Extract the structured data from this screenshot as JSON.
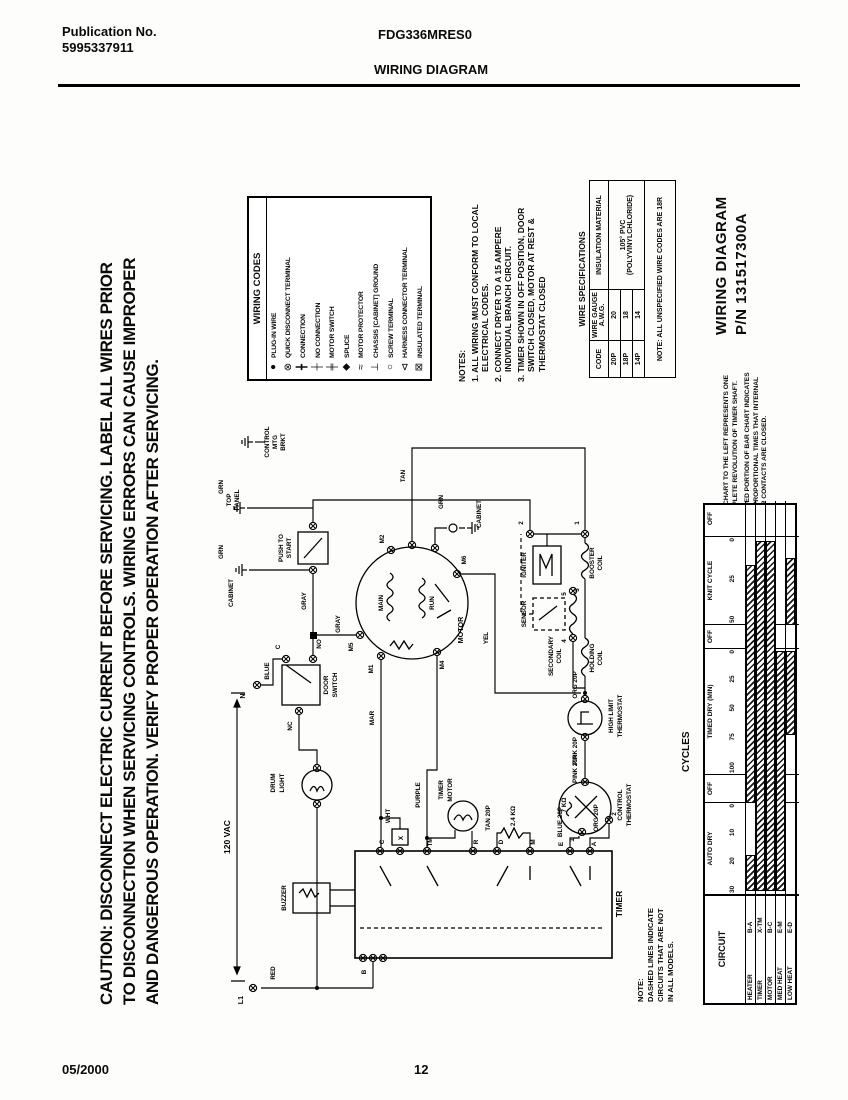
{
  "header": {
    "publication_label": "Publication No.",
    "publication_no": "5995337911",
    "model": "FDG336MRES0",
    "title": "WIRING DIAGRAM"
  },
  "footer": {
    "date": "05/2000",
    "page": "12"
  },
  "caution_lines": [
    "CAUTION: DISCONNECT ELECTRIC CURRENT BEFORE SERVICING. LABEL ALL WIRES PRIOR",
    "TO DISCONNECTION WHEN SERVICING CONTROLS. WIRING ERRORS CAN CAUSE IMPROPER",
    "AND DANGEROUS OPERATION. VERIFY PROPER OPERATION AFTER SERVICING."
  ],
  "legend": {
    "title": "WIRING CODES",
    "items": [
      {
        "name": "plug-in-wire",
        "glyph": "●",
        "label": "PLUG-IN WIRE"
      },
      {
        "name": "quick-disconnect-terminal",
        "glyph": "⊗",
        "label": "QUICK DISCONNECT TERMINAL"
      },
      {
        "name": "connection",
        "glyph": "╋",
        "label": "CONNECTION"
      },
      {
        "name": "no-connection",
        "glyph": "┼",
        "label": "NO CONNECTION"
      },
      {
        "name": "motor-switch",
        "glyph": "╪",
        "label": "MOTOR SWITCH"
      },
      {
        "name": "splice",
        "glyph": "◆",
        "label": "SPLICE"
      },
      {
        "name": "motor-protector",
        "glyph": "≈",
        "label": "MOTOR PROTECTOR"
      },
      {
        "name": "chassis-cabinet-ground",
        "glyph": "⊥",
        "label": "CHASSIS [CABINET] GROUND"
      },
      {
        "name": "screw-terminal",
        "glyph": "○",
        "label": "SCREW TERMINAL"
      },
      {
        "name": "harness-connector-terminal",
        "glyph": "⊲",
        "label": "HARNESS CONNECTOR TERMINAL"
      },
      {
        "name": "insulated-terminal",
        "glyph": "⊠",
        "label": "INSULATED TERMINAL"
      }
    ]
  },
  "notes": {
    "title": "NOTES:",
    "items": [
      "1. ALL WIRING MUST CONFORM TO LOCAL ELECTRICAL CODES.",
      "2. CONNECT DRYER TO A 15 AMPERE INDIVIDUAL BRANCH CIRCUIT.",
      "3. TIMER SHOWN IN OFF POSITION, DOOR SWITCH CLOSED, MOTOR AT REST & THERMOSTAT CLOSED"
    ]
  },
  "wire_specs": {
    "title": "WIRE SPECIFICATIONS",
    "col_code": "CODE",
    "col_gauge": "WIRE GAUGE A.W.G.",
    "col_insulation": "INSULATION MATERIAL",
    "rows": [
      [
        "20P",
        "20"
      ],
      [
        "18P",
        "18"
      ],
      [
        "14P",
        "14"
      ]
    ],
    "insulation": "105° PVC (POLYVINYLCHLORIDE)",
    "note": "NOTE: ALL UNSPECIFIED WIRE CODES ARE 18R"
  },
  "side_title": {
    "line1": "WIRING DIAGRAM",
    "line2": "P/N 131517300A"
  },
  "bar_note_lines": [
    "BAR CHART TO THE LEFT REPRESENTS ONE",
    "COMPLETE REVOLUTION OF TIMER SHAFT.",
    "SHADED PORTION OF BAR CHART INDICATES",
    "THE PROPORTIONAL TIMES THAT INTERNAL",
    "TIMER CONTACTS ARE CLOSED."
  ],
  "dashed_note_lines": [
    "NOTE:",
    "DASHED LINES INDICATE",
    "CIRCUITS THAT ARE NOT",
    "IN ALL MODELS."
  ],
  "cycles": {
    "title": "CYCLES",
    "circuit_header": "CIRCUIT",
    "sections": [
      {
        "label": "AUTO DRY",
        "x": 108,
        "w": 92,
        "ticks": [
          "30",
          "20",
          "10",
          "0"
        ]
      },
      {
        "label": "OFF",
        "x": 200,
        "w": 28,
        "ticks": []
      },
      {
        "label": "TIMED DRY (MIN)",
        "x": 228,
        "w": 126,
        "ticks": [
          "100",
          "75",
          "50",
          "25",
          "0"
        ]
      },
      {
        "label": "OFF",
        "x": 354,
        "w": 24,
        "ticks": []
      },
      {
        "label": "KNIT CYCLE",
        "x": 378,
        "w": 88,
        "ticks": [
          "50",
          "25",
          "0"
        ]
      },
      {
        "label": "OFF",
        "x": 466,
        "w": 36,
        "ticks": []
      }
    ],
    "rows": [
      {
        "name": "HEATER",
        "code": "B-A",
        "segments": [
          [
            112,
            148
          ],
          [
            200,
            438
          ]
        ]
      },
      {
        "name": "TIMER",
        "code": "X-TM",
        "segments": [
          [
            112,
            462
          ]
        ]
      },
      {
        "name": "MOTOR",
        "code": "B-C",
        "segments": [
          [
            112,
            462
          ]
        ]
      },
      {
        "name": "MED HEAT",
        "code": "E-M",
        "segments": [
          [
            112,
            352
          ]
        ]
      },
      {
        "name": "LOW HEAT",
        "code": "E-D",
        "segments": [
          [
            268,
            352
          ],
          [
            378,
            445
          ]
        ]
      }
    ]
  },
  "schematic": {
    "labels": {
      "term_n": "N",
      "term_l1": "L1",
      "vac": "120 VAC",
      "red": "RED",
      "blue": "BLUE",
      "grn_top": "GRN",
      "grn_bottom": "GRN",
      "grn_motor": "GRN",
      "top_panel_1": "TOP",
      "top_panel_2": "PANEL",
      "cabinet_gnd": "CABINET",
      "cabinet_top": "CABINET",
      "control_mtg_1": "CONTROL",
      "control_mtg_2": "MTG",
      "control_mtg_3": "BRKT",
      "push_start_1": "PUSH TO",
      "push_start_2": "START",
      "gray_1": "GRAY",
      "gray_2": "GRAY",
      "door_switch_1": "DOOR",
      "door_switch_2": "SWITCH",
      "term_c": "C",
      "term_no": "NO",
      "term_nc": "NC",
      "drum_1": "DRUM",
      "drum_2": "LIGHT",
      "buzzer": "BUZZER",
      "motor": "MOTOR",
      "main": "MAIN",
      "run": "RUN",
      "m1": "M1",
      "m2": "M2",
      "m4": "M4",
      "m5": "M5",
      "m6": "M6",
      "mar": "MAR",
      "wht": "WHT",
      "purple": "PURPLE",
      "tan": "TAN",
      "yel": "YEL",
      "num1": "1",
      "num2": "2",
      "num3": "3",
      "num4": "4",
      "num5": "5",
      "igniter": "IGNITER",
      "sensor": "SENSOR",
      "booster_1": "BOOSTER",
      "booster_2": "COIL",
      "secondary_1": "SECONDARY",
      "secondary_2": "COIL",
      "holding_1": "HOLDING",
      "holding_2": "COIL",
      "org20_a": "ORG 20P",
      "org20_b": "ORG 20P",
      "pink20_a": "PINK 20P",
      "pink20_b": "PINK 20P",
      "blue20": "BLUE 20P",
      "tan20": "TAN 20P",
      "highlimit_1": "HIGH LIMIT",
      "highlimit_2": "THERMOSTAT",
      "ctrl_thermo_1": "CONTROL",
      "ctrl_thermo_2": "THERMOSTAT",
      "r7k": "7 KΩ",
      "r24k": "2.4 KΩ",
      "timer_motor_1": "TIMER",
      "timer_motor_2": "MOTOR",
      "timer": "TIMER",
      "t_c": "C",
      "t_x": "X",
      "t_tm": "TM",
      "t_r": "R",
      "t_d": "D",
      "t_m": "M",
      "t_e": "E",
      "t_a": "A",
      "t_b": "B",
      "ctrl_1": "1",
      "ctrl_2": "2"
    }
  }
}
